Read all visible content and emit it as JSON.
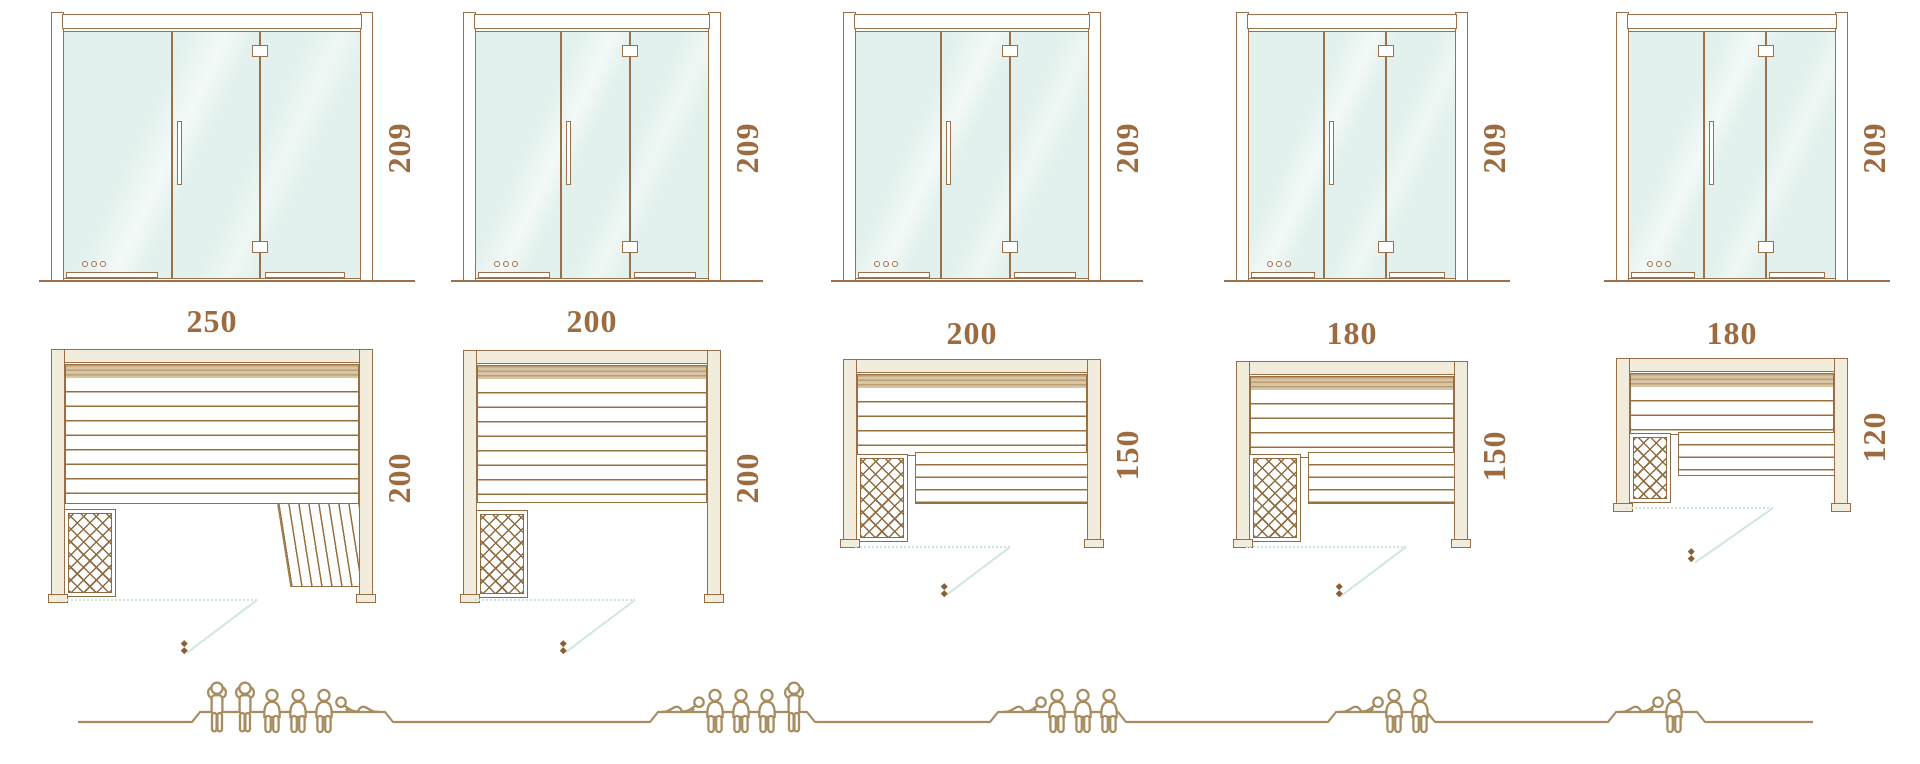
{
  "diagram": {
    "title": "sauna-models-size-comparison",
    "rows": [
      "door-elevations",
      "floor-plans",
      "capacity-figures"
    ]
  },
  "columns": [
    {
      "door_height": "209",
      "width_label": "250",
      "depth_label": "200",
      "capacity": 6,
      "people": [
        "standing",
        "standing",
        "sitting",
        "sitting",
        "sitting",
        "lying-right"
      ]
    },
    {
      "door_height": "209",
      "width_label": "200",
      "depth_label": "200",
      "capacity": 5,
      "people": [
        "lying",
        "sitting",
        "sitting",
        "sitting",
        "standing"
      ]
    },
    {
      "door_height": "209",
      "width_label": "200",
      "depth_label": "150",
      "capacity": 4,
      "people": [
        "lying",
        "sitting",
        "sitting",
        "sitting"
      ]
    },
    {
      "door_height": "209",
      "width_label": "180",
      "depth_label": "150",
      "capacity": 3,
      "people": [
        "lying",
        "sitting",
        "sitting"
      ]
    },
    {
      "door_height": "209",
      "width_label": "180",
      "depth_label": "120",
      "capacity": 2,
      "people": [
        "lying",
        "sitting"
      ]
    }
  ],
  "colors": {
    "outline_brown": "#9c7049",
    "slat_brown": "#96703f",
    "dimension_text": "#9c6b3f",
    "glass_mint": "#e2f1ed",
    "wall_cream": "#f1ecdb",
    "bench_band_tan": "#d8c5a4",
    "swing_teal": "#cfe7e1",
    "people_gold": "#a68c5f",
    "marker_dark_brown": "#8a5f35"
  }
}
